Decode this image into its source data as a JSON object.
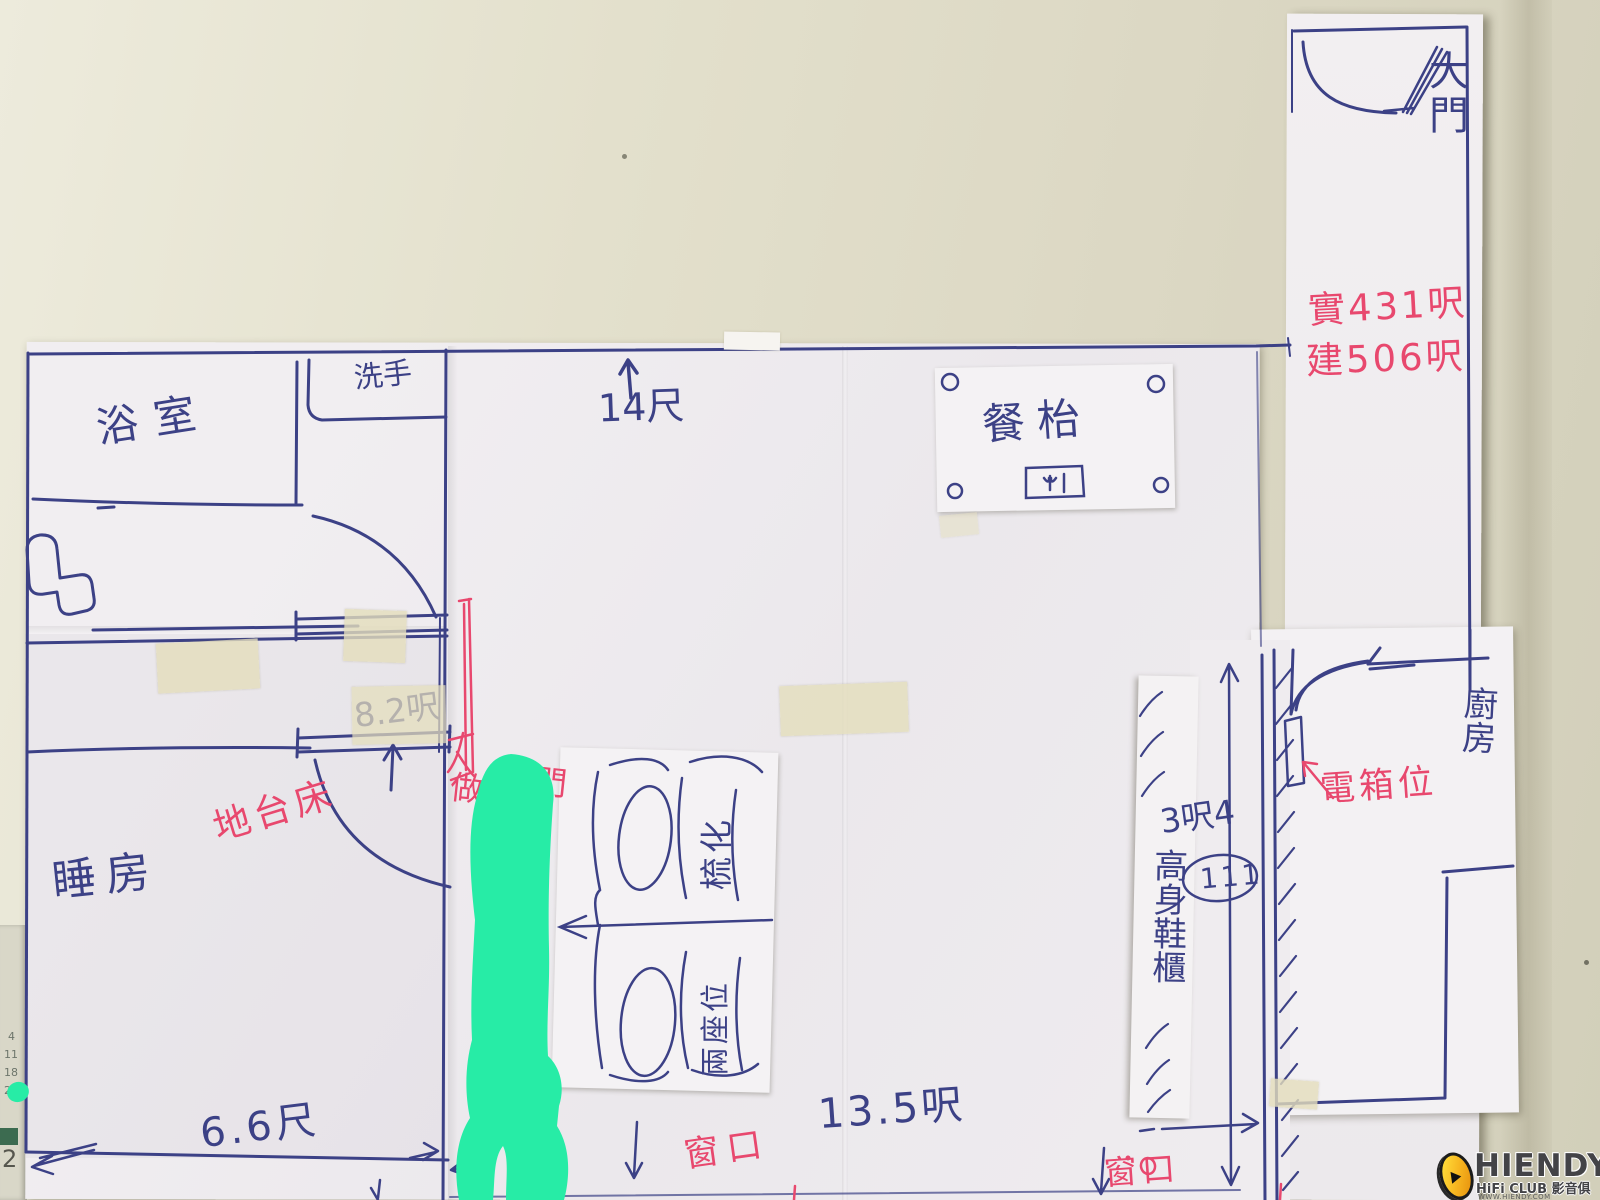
{
  "plan": {
    "rooms": {
      "main_gate": "大門",
      "bathroom": "浴室",
      "washbasin": "洗手",
      "bedroom": "睡房",
      "kitchen": "廚房"
    },
    "furniture": {
      "dining_table": "餐枱",
      "sofa": "梳化",
      "sofa_seats": "兩座位",
      "platform_bed": "地台床",
      "tall_cabinet": "高身鞋櫃",
      "electric_box": "電箱位"
    },
    "annotations": {
      "area_actual": "實431呎",
      "area_built": "建506呎",
      "make_room_door": "做房",
      "door_char": "門",
      "window_a": "窗口",
      "window_b": "窗口",
      "circled_mark": "111"
    },
    "dimensions": {
      "top_width": "14尺",
      "bedroom_door": "8.2呎",
      "bedroom_width": "6.6尺",
      "living_width": "13.5呎",
      "corridor_width": "3呎4"
    },
    "underlay": {
      "n1": "4",
      "n2": "11",
      "n3": "18",
      "n4": "25",
      "digit": "2"
    }
  },
  "watermark": {
    "brand": "HIENDY",
    "club": "HiFi CLUB",
    "club_cn": "影音俱樂部",
    "url": "WWW.HIENDY.COM"
  },
  "colors": {
    "pen_blue": "#3c4186",
    "pen_red": "#e8486e",
    "highlight_green": "#27eca6",
    "paper_white": "#f0edf0",
    "wall_beige": "#dedbc6",
    "tape_beige": "#e4ddbc",
    "logo_yellow": "#f6b41f"
  }
}
